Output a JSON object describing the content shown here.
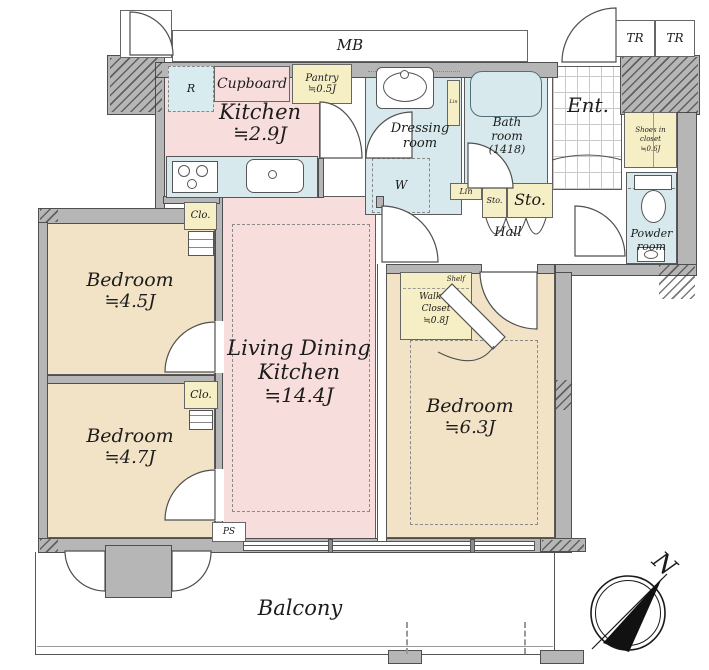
{
  "colors": {
    "wall": "#b6b6b6",
    "ldk_pink": "#f8dddd",
    "bedroom_cream": "#f3e3c6",
    "wet_blue": "#d7e9ed",
    "closet_yellow": "#f6efc5"
  },
  "top": {
    "tr_left": "TR",
    "mb": "MB",
    "tr_right_a": "TR",
    "tr_right_b": "TR"
  },
  "kitchen": {
    "name": "Kitchen",
    "size": "≒2.9J",
    "fridge": "R",
    "cupboard": "Cupboard",
    "pantry_name": "Pantry",
    "pantry_size": "≒0.5J"
  },
  "dressing": {
    "line1": "Dressing",
    "line2": "room",
    "washer": "W",
    "linen": "Lin"
  },
  "bath": {
    "line1": "Bath",
    "line2": "room",
    "line3": "(1418)"
  },
  "entrance": {
    "name": "Ent.",
    "shoes_line1": "Shoes in",
    "shoes_line2": "closet",
    "shoes_line3": "≒0.6J"
  },
  "hall": {
    "name": "Hall",
    "linen": "Lin",
    "storage_small": "Sto.",
    "storage_large": "Sto."
  },
  "powder": {
    "line1": "Powder",
    "line2": "room"
  },
  "wic": {
    "shelf": "Shelf",
    "line1": "Walk in",
    "line2": "Closet",
    "size": "≒0.8J"
  },
  "ldk": {
    "line1": "Living Dining",
    "line2": "Kitchen",
    "size": "≒14.4J",
    "ps": "PS"
  },
  "bedroom1": {
    "name": "Bedroom",
    "size": "≒4.5J",
    "closet": "Clo."
  },
  "bedroom2": {
    "name": "Bedroom",
    "size": "≒4.7J",
    "closet": "Clo."
  },
  "bedroom3": {
    "name": "Bedroom",
    "size": "≒6.3J"
  },
  "balcony": {
    "name": "Balcony"
  },
  "compass": {
    "north": "N"
  }
}
